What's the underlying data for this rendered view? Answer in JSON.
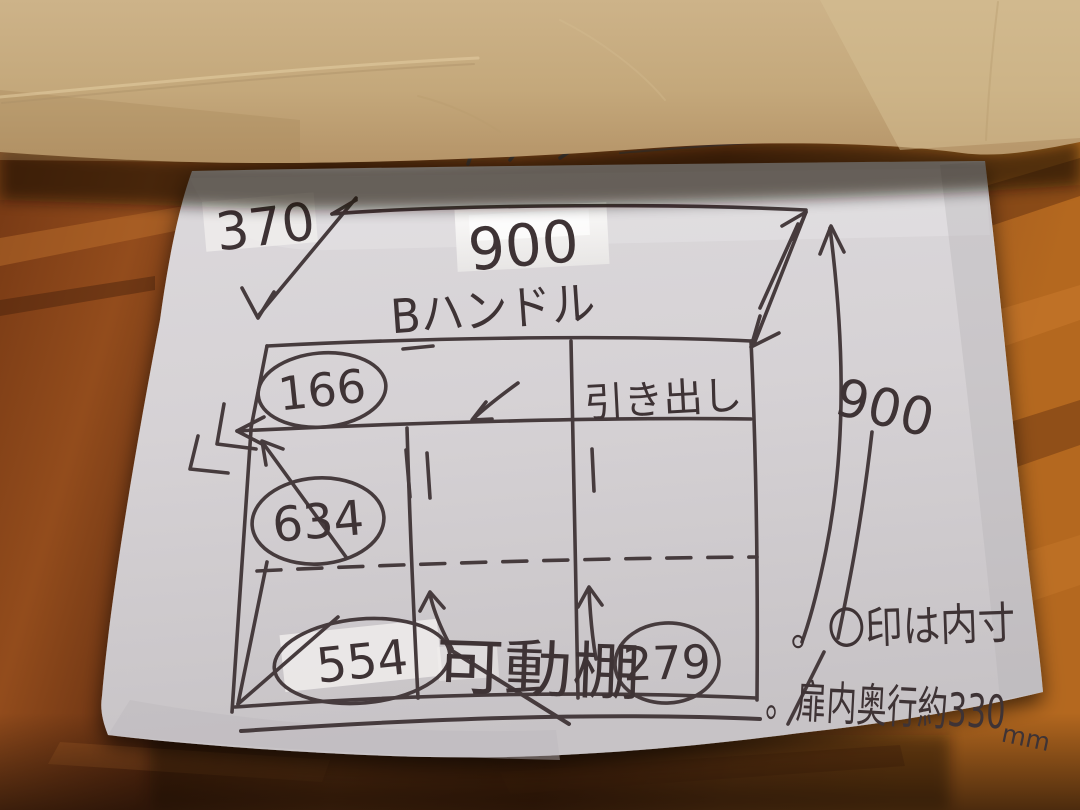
{
  "sketch": {
    "depth_top_left": "370",
    "width_top": "900",
    "handle_label": "Bハンドル",
    "drawer_label": "引き出し",
    "height_right": "900",
    "shelf_label": "可動棚",
    "circled_top_height": "166",
    "circled_middle_height": "634",
    "circled_bottom_left_width": "554",
    "circled_bottom_right_width": "279",
    "note_circle_meaning": "。〇印は内寸",
    "note_door_depth": "。扉内奥行約330",
    "note_door_depth_unit": "mm"
  },
  "colors": {
    "ink": "#3e3335",
    "stroke": "#463b3d",
    "paper": "#d6d2d5",
    "envelope": "#c6aa7d",
    "tape": "#f1efee",
    "wood": "#8a4418"
  }
}
